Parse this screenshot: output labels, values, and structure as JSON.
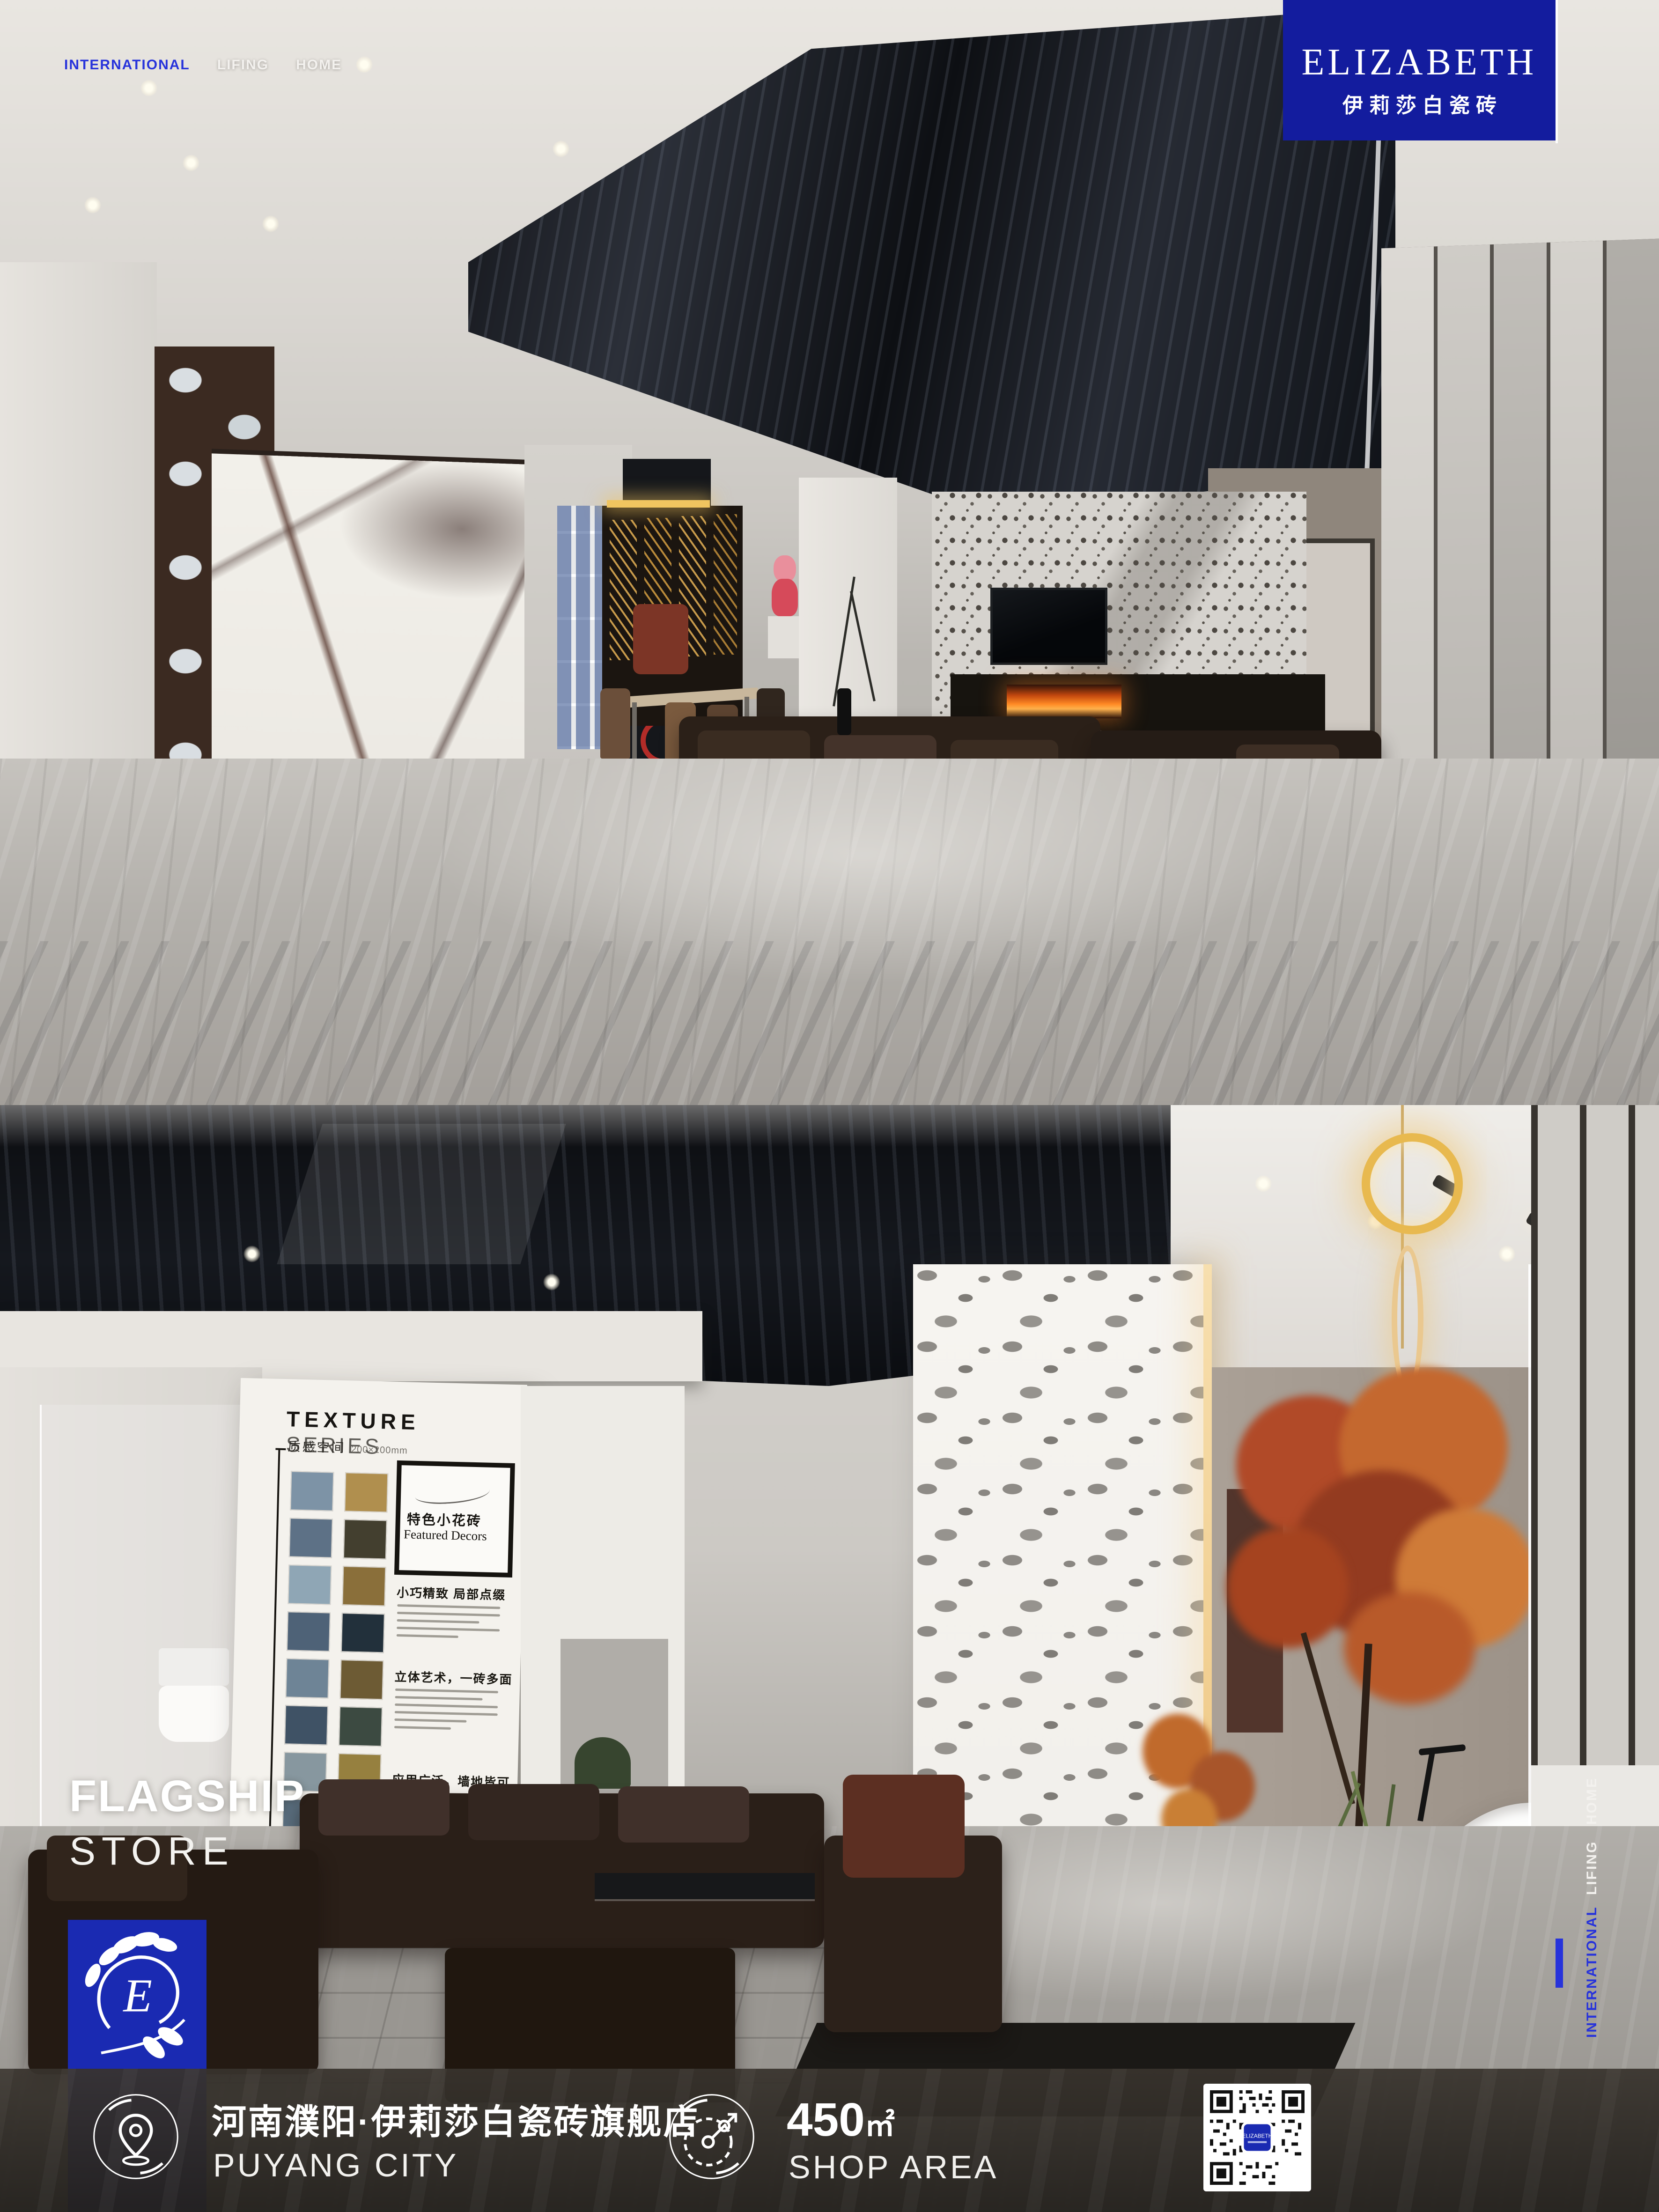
{
  "brand": {
    "name": "ELIZABETH",
    "chinese": "伊莉莎白瓷砖",
    "accent_blue": "#2733db",
    "panel_blue": "#131c9e",
    "logo_square_blue": "#1a2ab2"
  },
  "nav_top": {
    "items": [
      {
        "label": "INTERNATIONAL",
        "active": true
      },
      {
        "label": "LIFING",
        "active": false
      },
      {
        "label": "HOME",
        "active": false
      }
    ]
  },
  "nav_side": {
    "items": [
      {
        "label": "HOME",
        "active": false
      },
      {
        "label": "LIFING",
        "active": false
      },
      {
        "label": "INTERNATIONAL",
        "active": true
      }
    ]
  },
  "hero": {
    "title_line1": "FLAGSHIP",
    "title_line2": "STORE"
  },
  "footer": {
    "location_cn": "河南濮阳·伊莉莎白瓷砖旗舰店",
    "location_en": "PUYANG CITY",
    "area_value": "450",
    "area_unit": "㎡",
    "area_label": "SHOP AREA",
    "qr_label": "ELIZABETH",
    "icons": [
      "location-pin-icon",
      "compass-area-icon",
      "qr-code"
    ]
  },
  "poster": {
    "title": "TEXTURE",
    "title2": "SERIES",
    "subtitle_cn": "质感空间",
    "size_note": "200×200mm",
    "badge_cn": "特色小花砖",
    "badge_en": "Featured Decors",
    "sections": [
      "小巧精致 局部点缀",
      "立体艺术，一砖多面",
      "应用广泛，墙地皆可"
    ],
    "footer_label": "ART",
    "swatch_colors_left": [
      "#7d93a6",
      "#5d7186",
      "#8fa6b5",
      "#4e6277",
      "#6e8496",
      "#3f5265",
      "#87979f",
      "#5a6e7e",
      "#70828f"
    ],
    "swatch_colors_right": [
      "#b08f4e",
      "#433f2f",
      "#8a6f3a",
      "#22303b",
      "#6d5b34",
      "#3c4a41",
      "#96803f",
      "#2c3a30",
      "#7b6a3c"
    ]
  }
}
